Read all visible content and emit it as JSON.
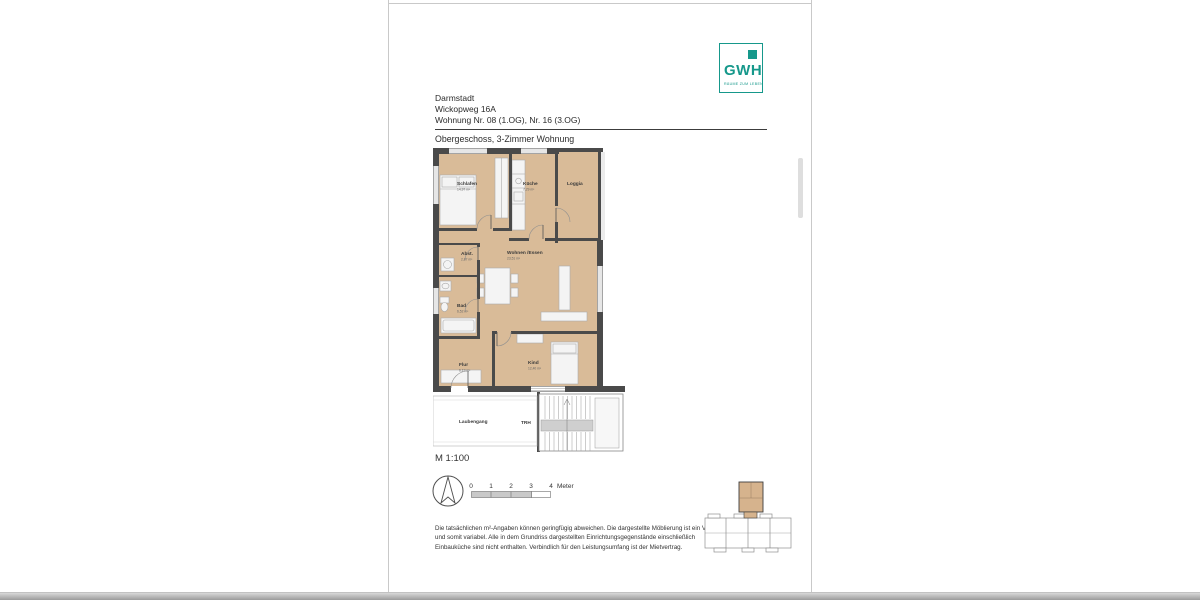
{
  "document": {
    "header": {
      "city": "Darmstadt",
      "street": "Wickopweg 16A",
      "unit_line": "Wohnung Nr. 08 (1.OG), Nr. 16 (3.OG)",
      "subtitle": "Obergeschoss, 3-Zimmer Wohnung"
    },
    "logo": {
      "name": "GWH",
      "tagline": "RÄUME ZUM LEBEN",
      "brand_color": "#16988b"
    },
    "floorplan": {
      "rooms": [
        {
          "name": "Schlafen",
          "area": "14,97 m²"
        },
        {
          "name": "Küche",
          "area": "7,29 m²"
        },
        {
          "name": "Loggia",
          "area": ""
        },
        {
          "name": "Abst.",
          "area": "2,87 m²"
        },
        {
          "name": "Wohnen /Essen",
          "area": "23,51 m²"
        },
        {
          "name": "Bad",
          "area": "6,52 m²"
        },
        {
          "name": "Flur",
          "area": "6,19 m²"
        },
        {
          "name": "Kind",
          "area": "12,40 m²"
        },
        {
          "name": "Laubengang",
          "area": ""
        },
        {
          "name": "TRH",
          "area": ""
        }
      ],
      "wall_color": "#4a4a4a",
      "floor_color": "#d9bb98"
    },
    "scale": {
      "label": "M 1:100",
      "ticks": [
        "0",
        "1",
        "2",
        "3",
        "4"
      ],
      "unit": "Meter"
    },
    "disclaimer": "Die tatsächlichen m²-Angaben können geringfügig abweichen. Die dargestellte Möblierung ist ein Vorschlag und somit variabel. Alle in dem Grundriss dargestellten Einrichtungsgegenstände einschließlich Einbauküche sind nicht enthalten. Verbindlich für den Leistungsumfang ist der Mietvertrag."
  }
}
